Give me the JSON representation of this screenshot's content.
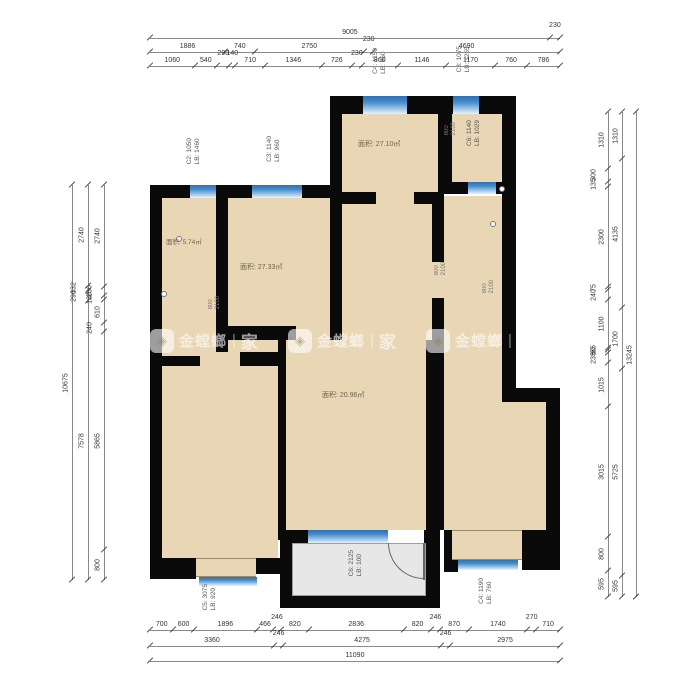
{
  "colors": {
    "wall": "#0a0a0a",
    "room_fill": "#e9d6b4",
    "balcony_fill": "#e7e7e7",
    "window_dark": "#2a72b8",
    "window_light": "#eaf3fb",
    "dim_text": "#333333"
  },
  "rooms": [
    {
      "id": "bedroom-top",
      "area_label": "面积: 27.10㎡"
    },
    {
      "id": "room-left-small",
      "area_label": "面积: 5.74㎡"
    },
    {
      "id": "bedroom-left",
      "area_label": "面积: 27.33㎡"
    },
    {
      "id": "living-room",
      "area_label": "面积: 20.96㎡"
    }
  ],
  "window_labels": [
    {
      "id": "w-top-1",
      "lines": [
        "C4: 1150",
        "LB: 960"
      ]
    },
    {
      "id": "w-top-2",
      "lines": [
        "C3: 1075",
        "LB: 1255"
      ]
    },
    {
      "id": "w-left-1",
      "lines": [
        "C2: 1050",
        "LB: 1460"
      ]
    },
    {
      "id": "w-left-2",
      "lines": [
        "C3: 1140",
        "LB: 960"
      ]
    },
    {
      "id": "w-right-room",
      "lines": [
        "C6: 1140",
        "LB: 1029"
      ]
    },
    {
      "id": "w-balcony",
      "lines": [
        "C6: 2125",
        "LB: 100"
      ]
    },
    {
      "id": "w-bottom-left",
      "lines": [
        "C5: 3075",
        "LB: 920"
      ]
    },
    {
      "id": "w-bottom-right",
      "lines": [
        "C4: 1190",
        "LB: 760"
      ]
    }
  ],
  "door_labels": [
    {
      "id": "d-1",
      "lines": [
        "800",
        "2100"
      ]
    },
    {
      "id": "d-2",
      "lines": [
        "800",
        "2100"
      ]
    },
    {
      "id": "d-3",
      "lines": [
        "800",
        "2100"
      ]
    },
    {
      "id": "d-4",
      "lines": [
        "800",
        "2100"
      ]
    }
  ],
  "watermark": {
    "brand": "金螳螂",
    "divider": "|",
    "home": "家"
  },
  "dimensions": {
    "top": [
      [
        "9005",
        "230"
      ],
      [
        "1886",
        "740",
        "2750",
        "230",
        "4690"
      ],
      [
        "1060",
        "540",
        "290",
        "140",
        "710",
        "1346",
        "726",
        "230",
        "860",
        "1146",
        "1170",
        "760",
        "786"
      ]
    ],
    "bottom": [
      [
        "700",
        "600",
        "1896",
        "466",
        "246",
        "820",
        "2836",
        "820",
        "246",
        "870",
        "1740",
        "270",
        "710"
      ],
      [
        "3360",
        "246",
        "4275",
        "246",
        "2975"
      ],
      [
        "11090"
      ]
    ],
    "left": [
      [
        "10675"
      ],
      [
        "2740",
        "132",
        "290",
        "7578"
      ],
      [
        "2740",
        "230",
        "130",
        "610",
        "240",
        "5865",
        "800"
      ]
    ],
    "right": [
      [
        "1310",
        "300",
        "135",
        "2300",
        "75",
        "240",
        "1100",
        "55",
        "60",
        "235",
        "1015",
        "3015",
        "800",
        "595"
      ],
      [
        "1310",
        "4135",
        "1700",
        "5725",
        "595"
      ],
      [
        "13245"
      ]
    ]
  }
}
